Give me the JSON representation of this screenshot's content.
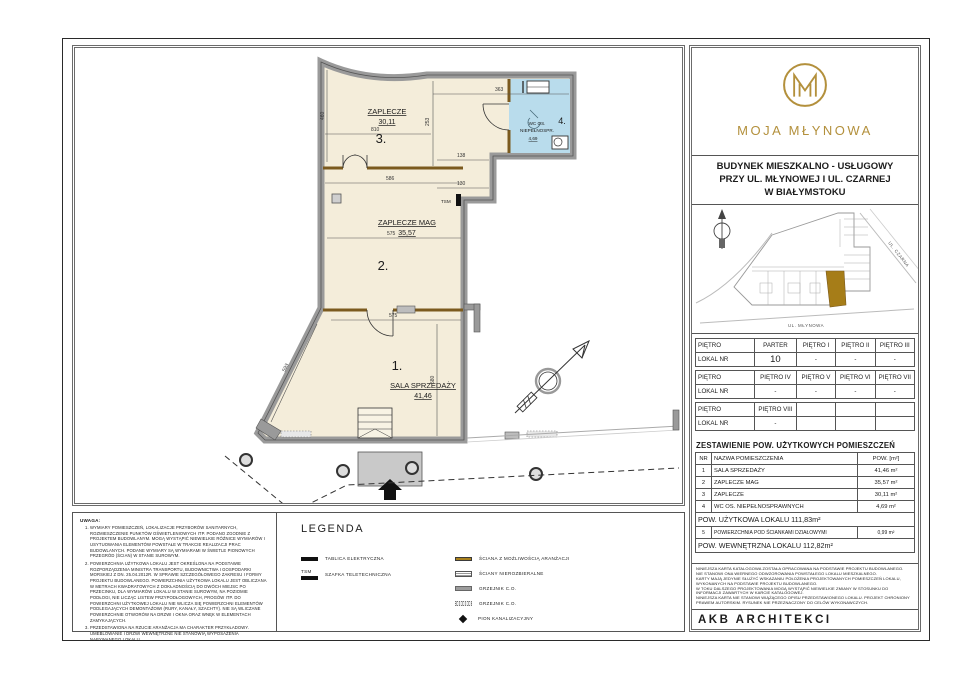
{
  "brand": {
    "monogram": "M",
    "name": "MOJA MŁYNOWA",
    "gold": "#b3903c"
  },
  "title_block": {
    "building_title_lines": [
      "BUDYNEK MIESZKALNO - USŁUGOWY",
      "PRZY UL. MŁYNOWEJ I UL. CZARNEJ",
      "W BIAŁYMSTOKU"
    ],
    "site_plan": {
      "street_diagonal": "UL. CZARNA",
      "street_bottom": "UL. MŁYNOWA"
    },
    "floor_table": {
      "rows": [
        [
          "PIĘTRO",
          "PARTER",
          "PIĘTRO I",
          "PIĘTRO II",
          "PIĘTRO III"
        ],
        [
          "LOKAL NR",
          "10",
          "-",
          "-",
          "-"
        ],
        [
          "PIĘTRO",
          "PIĘTRO IV",
          "PIĘTRO V",
          "PIĘTRO VI",
          "PIĘTRO VII"
        ],
        [
          "LOKAL NR",
          "-",
          "-",
          "-",
          "-"
        ],
        [
          "PIĘTRO",
          "PIĘTRO VIII",
          "",
          "",
          ""
        ],
        [
          "LOKAL NR",
          "-",
          "",
          "",
          ""
        ]
      ]
    },
    "area_table": {
      "title": "ZESTAWIENIE POW. UŻYTKOWYCH POMIESZCZEŃ",
      "headers": [
        "NR",
        "NAZWA POMIESZCZENIA",
        "POW. [m²]"
      ],
      "rows": [
        [
          "1",
          "SALA SPRZEDAŻY",
          "41,46 m²"
        ],
        [
          "2",
          "ZAPLECZE MAG",
          "35,57 m²"
        ],
        [
          "3",
          "ZAPLECZE",
          "30,11 m²"
        ],
        [
          "4",
          "WC OS. NIEPEŁNOSPRAWNYCH",
          "4,69 m²"
        ]
      ],
      "usable_area": "POW. UŻYTKOWA LOKALU  111,83m²",
      "row5": [
        "5",
        "POWIERZCHNIA POD ŚCIANKAMI DZIAŁOWYMI",
        "0,99 m²"
      ],
      "internal_area": "POW. WEWNĘTRZNA LOKALU  112,82m²"
    },
    "disclaimer_lines": [
      "NINIEJSZA KARTA KATALOGOWA ZOSTAŁA OPRACOWANA NA PODSTAWIE PROJEKTU BUDOWLANEGO.",
      "NIE STANOWI ONA WIERNEGO ODWZOROWANIA POWSTAŁEGO LOKALU MIESZKALNEGO.",
      "KARTY MAJĄ JEDYNIE SŁUŻYĆ WSKAZANIU POŁOŻENIA PROJEKTOWANYCH POMIESZCZEŃ LOKALU,",
      "WYKONANYCH NA PODSTAWIE PROJEKTU BUDOWLANEGO.",
      "W TOKU DALSZEGO PROJEKTOWANIA MOGĄ WYSTĄPIĆ NIEWIELKIE ZMIANY W STOSUNKU DO",
      "INFORMACJI ZAWARTYCH W KARCIE KATALOGOWEJ.",
      "NINIEJSZA KARTA NIE STANOWI WIĄŻĄCEGO OPISU PRZEDSTAWIONEGO LOKALU. PROJEKT CHRONIONY",
      "PRAWEM AUTORSKIM. RYSUNEK NIE PRZEZNACZONY DO CELÓW WYKONAWCZYCH."
    ],
    "studio_name": "AKB ARCHITEKCI"
  },
  "plan": {
    "rooms": [
      {
        "number": "1.",
        "name": "SALA SPRZEDAŻY",
        "area": "41,46"
      },
      {
        "number": "2.",
        "name": "ZAPLECZE MAG",
        "area": "35,57"
      },
      {
        "number": "3.",
        "name": "ZAPLECZE",
        "area": "30,11"
      },
      {
        "number": "4.",
        "name_line1": "WC OS.",
        "name_line2": "NIEPEŁNOSPR.",
        "area": "4,69"
      }
    ],
    "tsm_label": "TSM",
    "dims": {
      "d363": "363",
      "d253": "253",
      "d810": "810",
      "d460": "460",
      "d586": "586",
      "d138": "138",
      "d130": "130",
      "d575a": "575",
      "d575b": "575",
      "d580": "580",
      "d593": "593"
    },
    "colors": {
      "room_fill": "#f4edda",
      "wc_fill": "#b9dcec",
      "wall_gray": "#9a9a9a",
      "partition_gold": "#7b5a1e"
    }
  },
  "notes": {
    "heading": "UWAGA:",
    "items": [
      "WYMIARY POMIESZCZEŃ, LOKALIZACJE PRZYBORÓW SANITARNYCH, ROZMIESZCZENIE PUNKTÓW OŚWIETLENIOWYCH ITP. PODANO ZGODNIE Z PROJEKTEM BUDOWLANYM. MOGĄ WYSTĄPIĆ NIEWIELKIE RÓŻNICE WYMIARÓW I USYTUOWANIA ELEMENTÓW POWSTAŁE W TRAKCIE REALIZACJI PRAC BUDOWLANYCH. PODANE WYMIARY SĄ WYMIARAMI W ŚWIETLE PIONOWYCH PRZEGRÓD (ŚCIAN) W STANIE SUROWYM.",
      "POWIERZCHNIA UŻYTKOWA LOKALU JEST OKREŚLONA NA PODSTAWIE ROZPORZĄDZENIA MINISTRA TRANSPORTU, BUDOWNICTWA I GOSPODARKI MORSKIEJ Z DN. 25.04.2012R. W SPRAWIE SZCZEGÓŁOWEGO ZAKRESU I FORMY PROJEKTU BUDOWLANEGO. POWIERZCHNIA UŻYTKOWA LOKALU JEST OBLICZANA W METRACH KWADRATOWYCH Z DOKŁADNOŚCIĄ DO DWÓCH MIEJSC PO PRZECINKU, DLA WYMIARÓW LOKALU W STANIE SUROWYM, NA POZIOMIE PODŁOGI, NIE LICZĄC LISTEW PRZYPODŁOGOWYCH, PROGÓW ITP. DO POWIERZCHNI UŻYTKOWEJ LOKALU NIE WLICZA SIĘ POWIERZCHNI ELEMENTÓW PODLEGAJĄCYCH DEMONTAŻOWI (RURY, KANAŁY, SZACHTY). NIE SĄ WLICZANE POWIERZCHNIE OTWORÓW NA DRZWI I OKNA ORAZ WNĘK W ELEMENTACH ZAMYKAJĄCYCH.",
      "PRZEDSTAWIONA NA RZUCIE ARANŻACJA MA CHARAKTER PRZYKŁADOWY. UMEBLOWANIE I DRZWI WEWNĘTRZNE NIE STANOWIĄ WYPOSAŻENIA NABYWANEGO LOKALU."
    ]
  },
  "legend": {
    "title": "LEGENDA",
    "tsm_prefix": "TSM",
    "left_items": [
      "TABLICA ELEKTRYCZNA",
      "SZAFKA TELETECHNICZNA"
    ],
    "right_items": [
      "ŚCIANA Z MOŻLIWOŚCIĄ ARANŻACJI",
      "ŚCIANY NIEROZBIERALNE",
      "GRZEJNIK C.O.",
      "GRZEJNIK C.O.",
      "PION KANALIZACYJNY"
    ]
  }
}
